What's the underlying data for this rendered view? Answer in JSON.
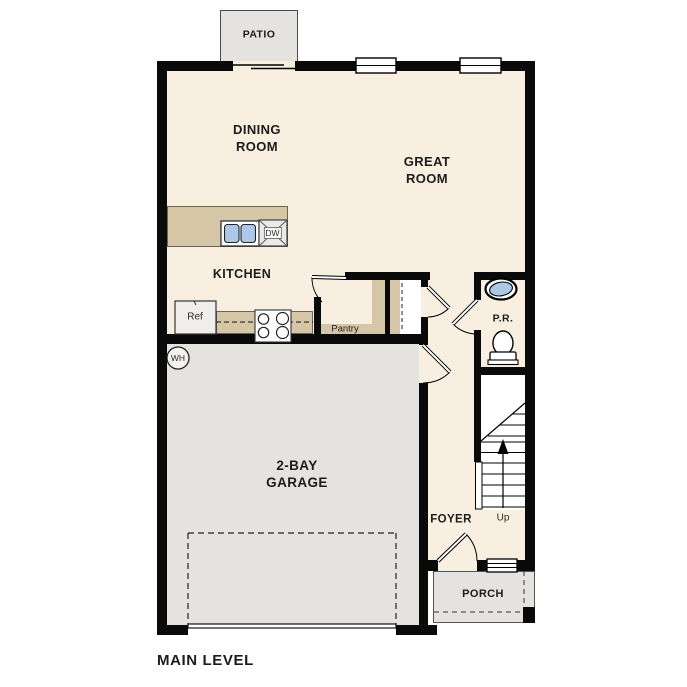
{
  "plan": {
    "title": "MAIN LEVEL",
    "rooms": {
      "dining": {
        "line1": "DINING",
        "line2": "ROOM"
      },
      "great": {
        "line1": "GREAT",
        "line2": "ROOM"
      },
      "kitchen": {
        "label": "KITCHEN"
      },
      "garage": {
        "line1": "2-BAY",
        "line2": "GARAGE"
      },
      "foyer": {
        "label": "FOYER"
      },
      "powder_room": {
        "label": "P.R."
      },
      "pantry": {
        "label": "Pantry"
      },
      "porch": {
        "label": "PORCH"
      },
      "patio": {
        "label": "PATIO"
      }
    },
    "fixtures": {
      "refrigerator": "Ref",
      "dishwasher": "DW",
      "water_heater": "WH",
      "stair_direction": "Up"
    },
    "colors": {
      "floor_cream": "#f8efe1",
      "cabinet_tan": "#d5c7a6",
      "garage_gray": "#e4e3e0",
      "sink_blue": "#abc8e8",
      "wall_black": "#0a0a0a"
    }
  }
}
